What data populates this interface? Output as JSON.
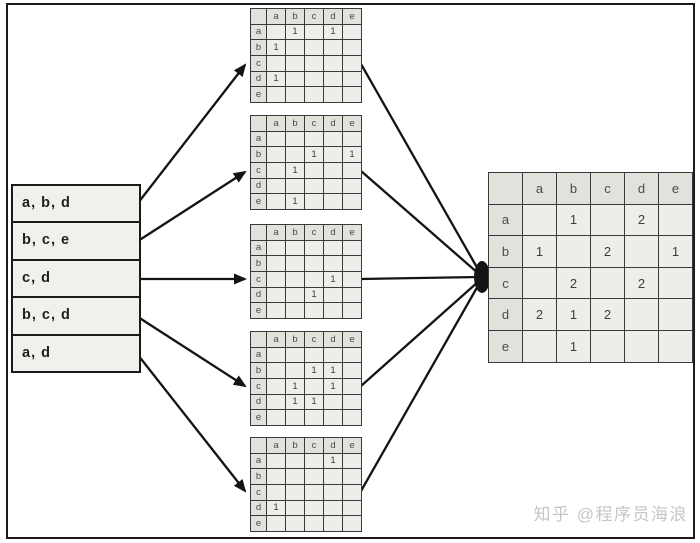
{
  "items": [
    "a",
    "b",
    "c",
    "d",
    "e"
  ],
  "transaction_list": {
    "rows": [
      "a, b, d",
      "b, c, e",
      "c, d",
      "b, c, d",
      "a, d"
    ]
  },
  "per_transaction_matrices": [
    {
      "transaction": "a, b, d",
      "cells": [
        [
          "",
          "1",
          "",
          "1",
          ""
        ],
        [
          "1",
          "",
          "",
          "",
          ""
        ],
        [
          "",
          "",
          "",
          "",
          ""
        ],
        [
          "1",
          "",
          "",
          "",
          ""
        ],
        [
          "",
          "",
          "",
          "",
          ""
        ]
      ]
    },
    {
      "transaction": "b, c, e",
      "cells": [
        [
          "",
          "",
          "",
          "",
          ""
        ],
        [
          "",
          "",
          "1",
          "",
          "1"
        ],
        [
          "",
          "1",
          "",
          "",
          ""
        ],
        [
          "",
          "",
          "",
          "",
          ""
        ],
        [
          "",
          "1",
          "",
          "",
          ""
        ]
      ]
    },
    {
      "transaction": "c, d",
      "cells": [
        [
          "",
          "",
          "",
          "",
          ""
        ],
        [
          "",
          "",
          "",
          "",
          ""
        ],
        [
          "",
          "",
          "",
          "1",
          ""
        ],
        [
          "",
          "",
          "1",
          "",
          ""
        ],
        [
          "",
          "",
          "",
          "",
          ""
        ]
      ]
    },
    {
      "transaction": "b, c, d",
      "cells": [
        [
          "",
          "",
          "",
          "",
          ""
        ],
        [
          "",
          "",
          "1",
          "1",
          ""
        ],
        [
          "",
          "1",
          "",
          "1",
          ""
        ],
        [
          "",
          "1",
          "1",
          "",
          ""
        ],
        [
          "",
          "",
          "",
          "",
          ""
        ]
      ]
    },
    {
      "transaction": "a, d",
      "cells": [
        [
          "",
          "",
          "",
          "1",
          ""
        ],
        [
          "",
          "",
          "",
          "",
          ""
        ],
        [
          "",
          "",
          "",
          "",
          ""
        ],
        [
          "1",
          "",
          "",
          "",
          ""
        ],
        [
          "",
          "",
          "",
          "",
          ""
        ]
      ]
    }
  ],
  "aggregate_matrix": {
    "cells": [
      [
        "",
        "1",
        "",
        "2",
        ""
      ],
      [
        "1",
        "",
        "2",
        "",
        "1"
      ],
      [
        "",
        "2",
        "",
        "2",
        ""
      ],
      [
        "2",
        "1",
        "2",
        "",
        ""
      ],
      [
        "",
        "1",
        "",
        "",
        ""
      ]
    ]
  },
  "watermark": {
    "text": "知乎 @程序员海浪"
  },
  "colors": {
    "cell_bg": "#eeedea",
    "header_bg": "#e3e1dc",
    "grid_line": "#3a3a3a",
    "arrow": "#141414",
    "watermark": "#c6c6c6"
  }
}
